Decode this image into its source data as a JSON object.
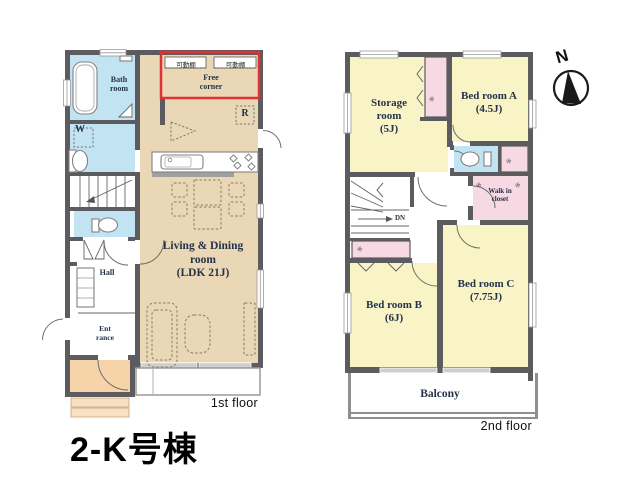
{
  "title": "2-K号棟",
  "compass": {
    "label": "N"
  },
  "floor1": {
    "floor_label": "1st floor",
    "bath_label": "Bath\nroom",
    "laundry_label": "W",
    "hall_label": "Hall",
    "entrance_label": "Ent\nrance",
    "living_label": "Living & Dining\nroom\n(LDK 21J)",
    "free_corner_label": "Free\ncorner",
    "shelf_left_label": "可動棚",
    "shelf_right_label": "可動棚",
    "fridge_label": "R"
  },
  "floor2": {
    "floor_label": "2nd floor",
    "storage_label": "Storage\nroom\n(5J)",
    "bedroom_a_label": "Bed room A\n(4.5J)",
    "bedroom_b_label": "Bed room B\n(6J)",
    "bedroom_c_label": "Bed room C\n(7.75J)",
    "walkin_closet_label": "Walk in\ncloset",
    "balcony_label": "Balcony",
    "down_label": "DN",
    "hanger_symbol": "※"
  },
  "colors": {
    "wall": "#5b5b60",
    "ldk": "#e9d7b5",
    "bedroom": "#f8f4c6",
    "closet": "#f7d9e4",
    "water": "#c2e4f2",
    "porch": "#f6d3a8",
    "porch_step": "#f8e0c4",
    "highlight_red": "#e03232",
    "label_text": "#25324a"
  }
}
